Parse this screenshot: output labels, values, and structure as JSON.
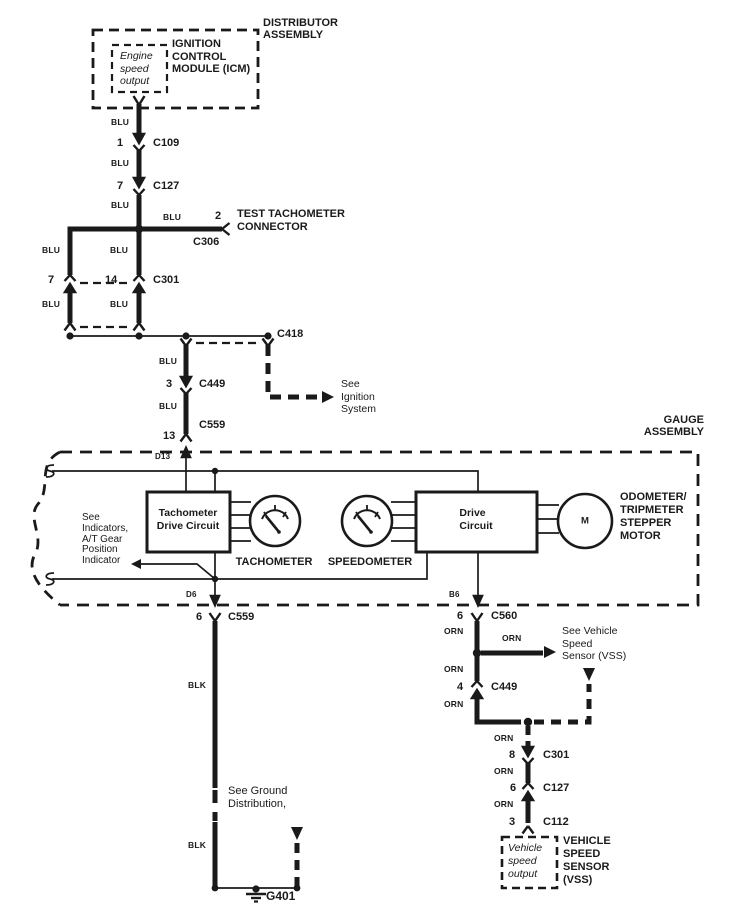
{
  "theme": {
    "ink": "#1a1a1a",
    "paper": "#ffffff"
  },
  "wire_colors": {
    "blu": "BLU",
    "blk": "BLK",
    "orn": "ORN"
  },
  "distributor": {
    "assembly": [
      "DISTRIBUTOR",
      "ASSEMBLY"
    ],
    "module": [
      "IGNITION",
      "CONTROL",
      "MODULE (ICM)"
    ],
    "output": [
      "Engine",
      "speed",
      "output"
    ]
  },
  "test_connector": {
    "pin": "2",
    "name": "C306",
    "label": [
      "TEST TACHOMETER",
      "CONNECTOR"
    ]
  },
  "connectors": {
    "c109": {
      "pin": "1",
      "name": "C109"
    },
    "c127_top": {
      "pin": "7",
      "name": "C127"
    },
    "c301_left": {
      "pin_a": "7",
      "pin_b": "14",
      "name": "C301"
    },
    "c418": "C418",
    "c449_left": {
      "pin": "3",
      "name": "C449"
    },
    "c559_top": {
      "pin": "13",
      "name": "C559"
    },
    "c559_bottom": {
      "pin": "6",
      "name": "C559"
    },
    "c560": {
      "pin": "6",
      "name": "C560"
    },
    "c449_right": {
      "pin": "4",
      "name": "C449"
    },
    "c301_right": {
      "pin": "8",
      "name": "C301"
    },
    "c127_right": {
      "pin": "6",
      "name": "C127"
    },
    "c112": {
      "pin": "3",
      "name": "C112"
    },
    "ground": "G401"
  },
  "terminals": {
    "d13": "D13",
    "d6": "D6",
    "b6": "B6"
  },
  "gauge_assembly": {
    "label": [
      "GAUGE",
      "ASSEMBLY"
    ],
    "tach_drive_circuit": [
      "Tachometer",
      "Drive Circuit"
    ],
    "tachometer": "TACHOMETER",
    "speedometer": "SPEEDOMETER",
    "drive_circuit": [
      "Drive",
      "Circuit"
    ],
    "motor": "M",
    "stepper": [
      "ODOMETER/",
      "TRIPMETER",
      "STEPPER",
      "MOTOR"
    ]
  },
  "vss": {
    "label": [
      "VEHICLE",
      "SPEED",
      "SENSOR",
      "(VSS)"
    ],
    "output": [
      "Vehicle",
      "speed",
      "output"
    ]
  },
  "notes": {
    "ignition": [
      "See",
      "Ignition",
      "System"
    ],
    "indicators": [
      "See",
      "Indicators,",
      "A/T Gear",
      "Position",
      "Indicator"
    ],
    "ground": [
      "See Ground",
      "Distribution,"
    ],
    "vss": [
      "See Vehicle",
      "Speed",
      "Sensor (VSS)"
    ]
  }
}
